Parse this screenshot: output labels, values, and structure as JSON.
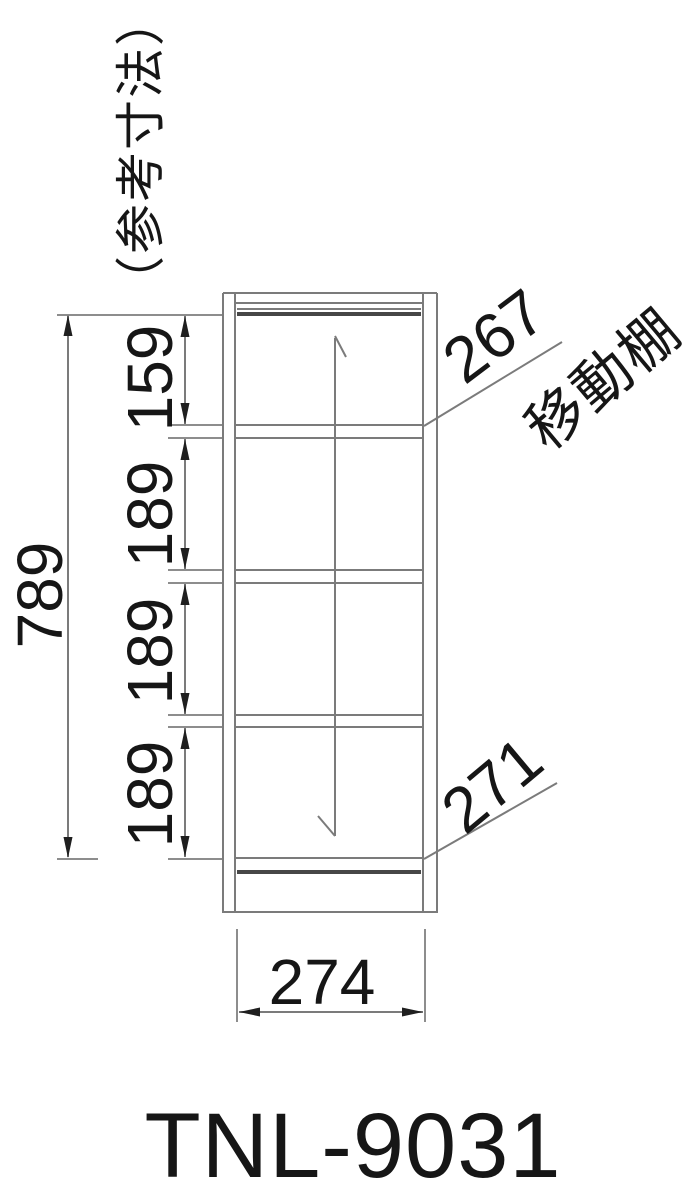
{
  "reference_note": "（参考寸法）",
  "model_number": "TNL-9031",
  "dims": {
    "overall_height": "789",
    "section_top": "159",
    "section_2": "189",
    "section_3": "189",
    "section_4": "189",
    "movable_shelf": "267",
    "bottom_shelf": "271",
    "overall_width": "274"
  },
  "labels": {
    "movable_shelf": "移動棚"
  },
  "colors": {
    "line": "#7b7b7b",
    "extension_line": "#8d8d8d",
    "dark_bar": "#474747",
    "arrow": "#1f1f1f",
    "text": "#161616",
    "background": "#ffffff"
  }
}
